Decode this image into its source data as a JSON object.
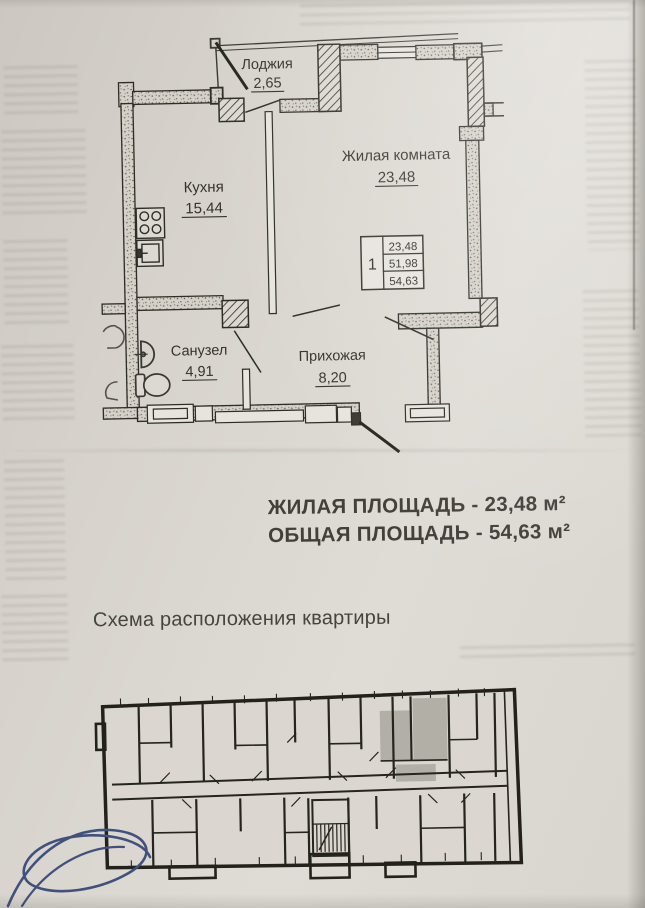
{
  "floor_plan": {
    "rooms": [
      {
        "name": "Лоджия",
        "area": "2,65"
      },
      {
        "name": "Кухня",
        "area": "15,44"
      },
      {
        "name": "Жилая комната",
        "area": "23,48"
      },
      {
        "name": "Санузел",
        "area": "4,91"
      },
      {
        "name": "Прихожая",
        "area": "8,20"
      }
    ],
    "stamp": {
      "apartment_number": "1",
      "row1": "23,48",
      "row2": "51,98",
      "row3": "54,63"
    }
  },
  "summary": {
    "line1": "ЖИЛАЯ ПЛОЩАДЬ - 23,48 м²",
    "line2": "ОБЩАЯ ПЛОЩАДЬ - 54,63 м²"
  },
  "scheme": {
    "title": "Схема расположения квартиры"
  },
  "colors": {
    "paper": "#d7d3cc",
    "ink": "#34322c",
    "highlight_gray": "#b2afa6",
    "signature_ink": "#41517d"
  }
}
